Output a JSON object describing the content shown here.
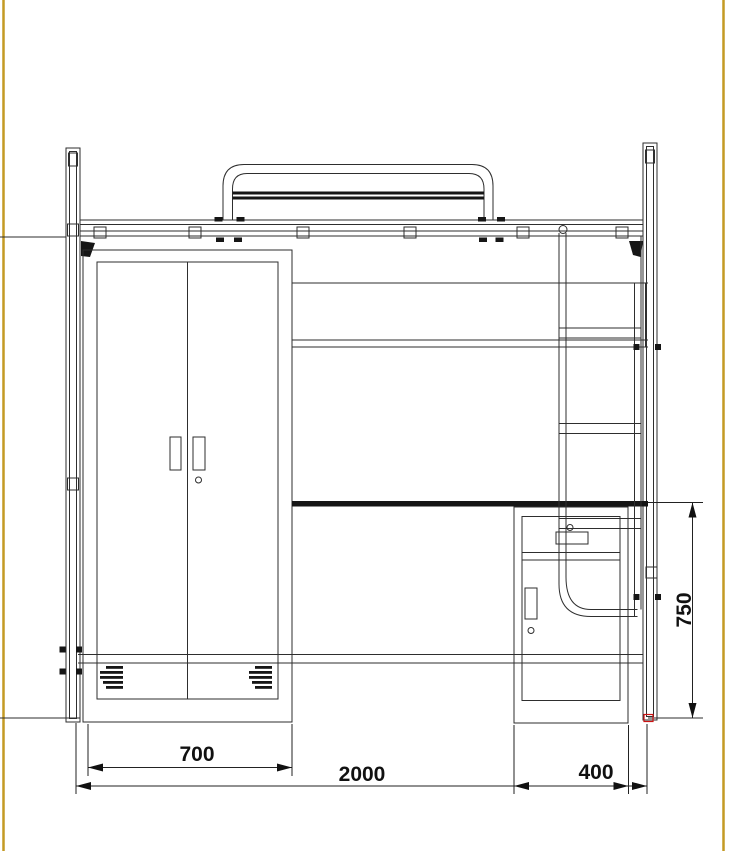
{
  "drawing": {
    "title": "loft-bed-elevation",
    "subject": "Loft bed elevation with wardrobe, bookshelf, desk, drawer cabinet and ladder"
  },
  "dimensions": {
    "wardrobe_width": "700",
    "overall_length": "2000",
    "cabinet_depth": "400",
    "desk_height": "750"
  },
  "colors": {
    "frame_border": "#c49a24",
    "line": "#2e2e2e",
    "desk_top": "#141414",
    "accent_red": "#cc1111",
    "background": "#ffffff"
  }
}
